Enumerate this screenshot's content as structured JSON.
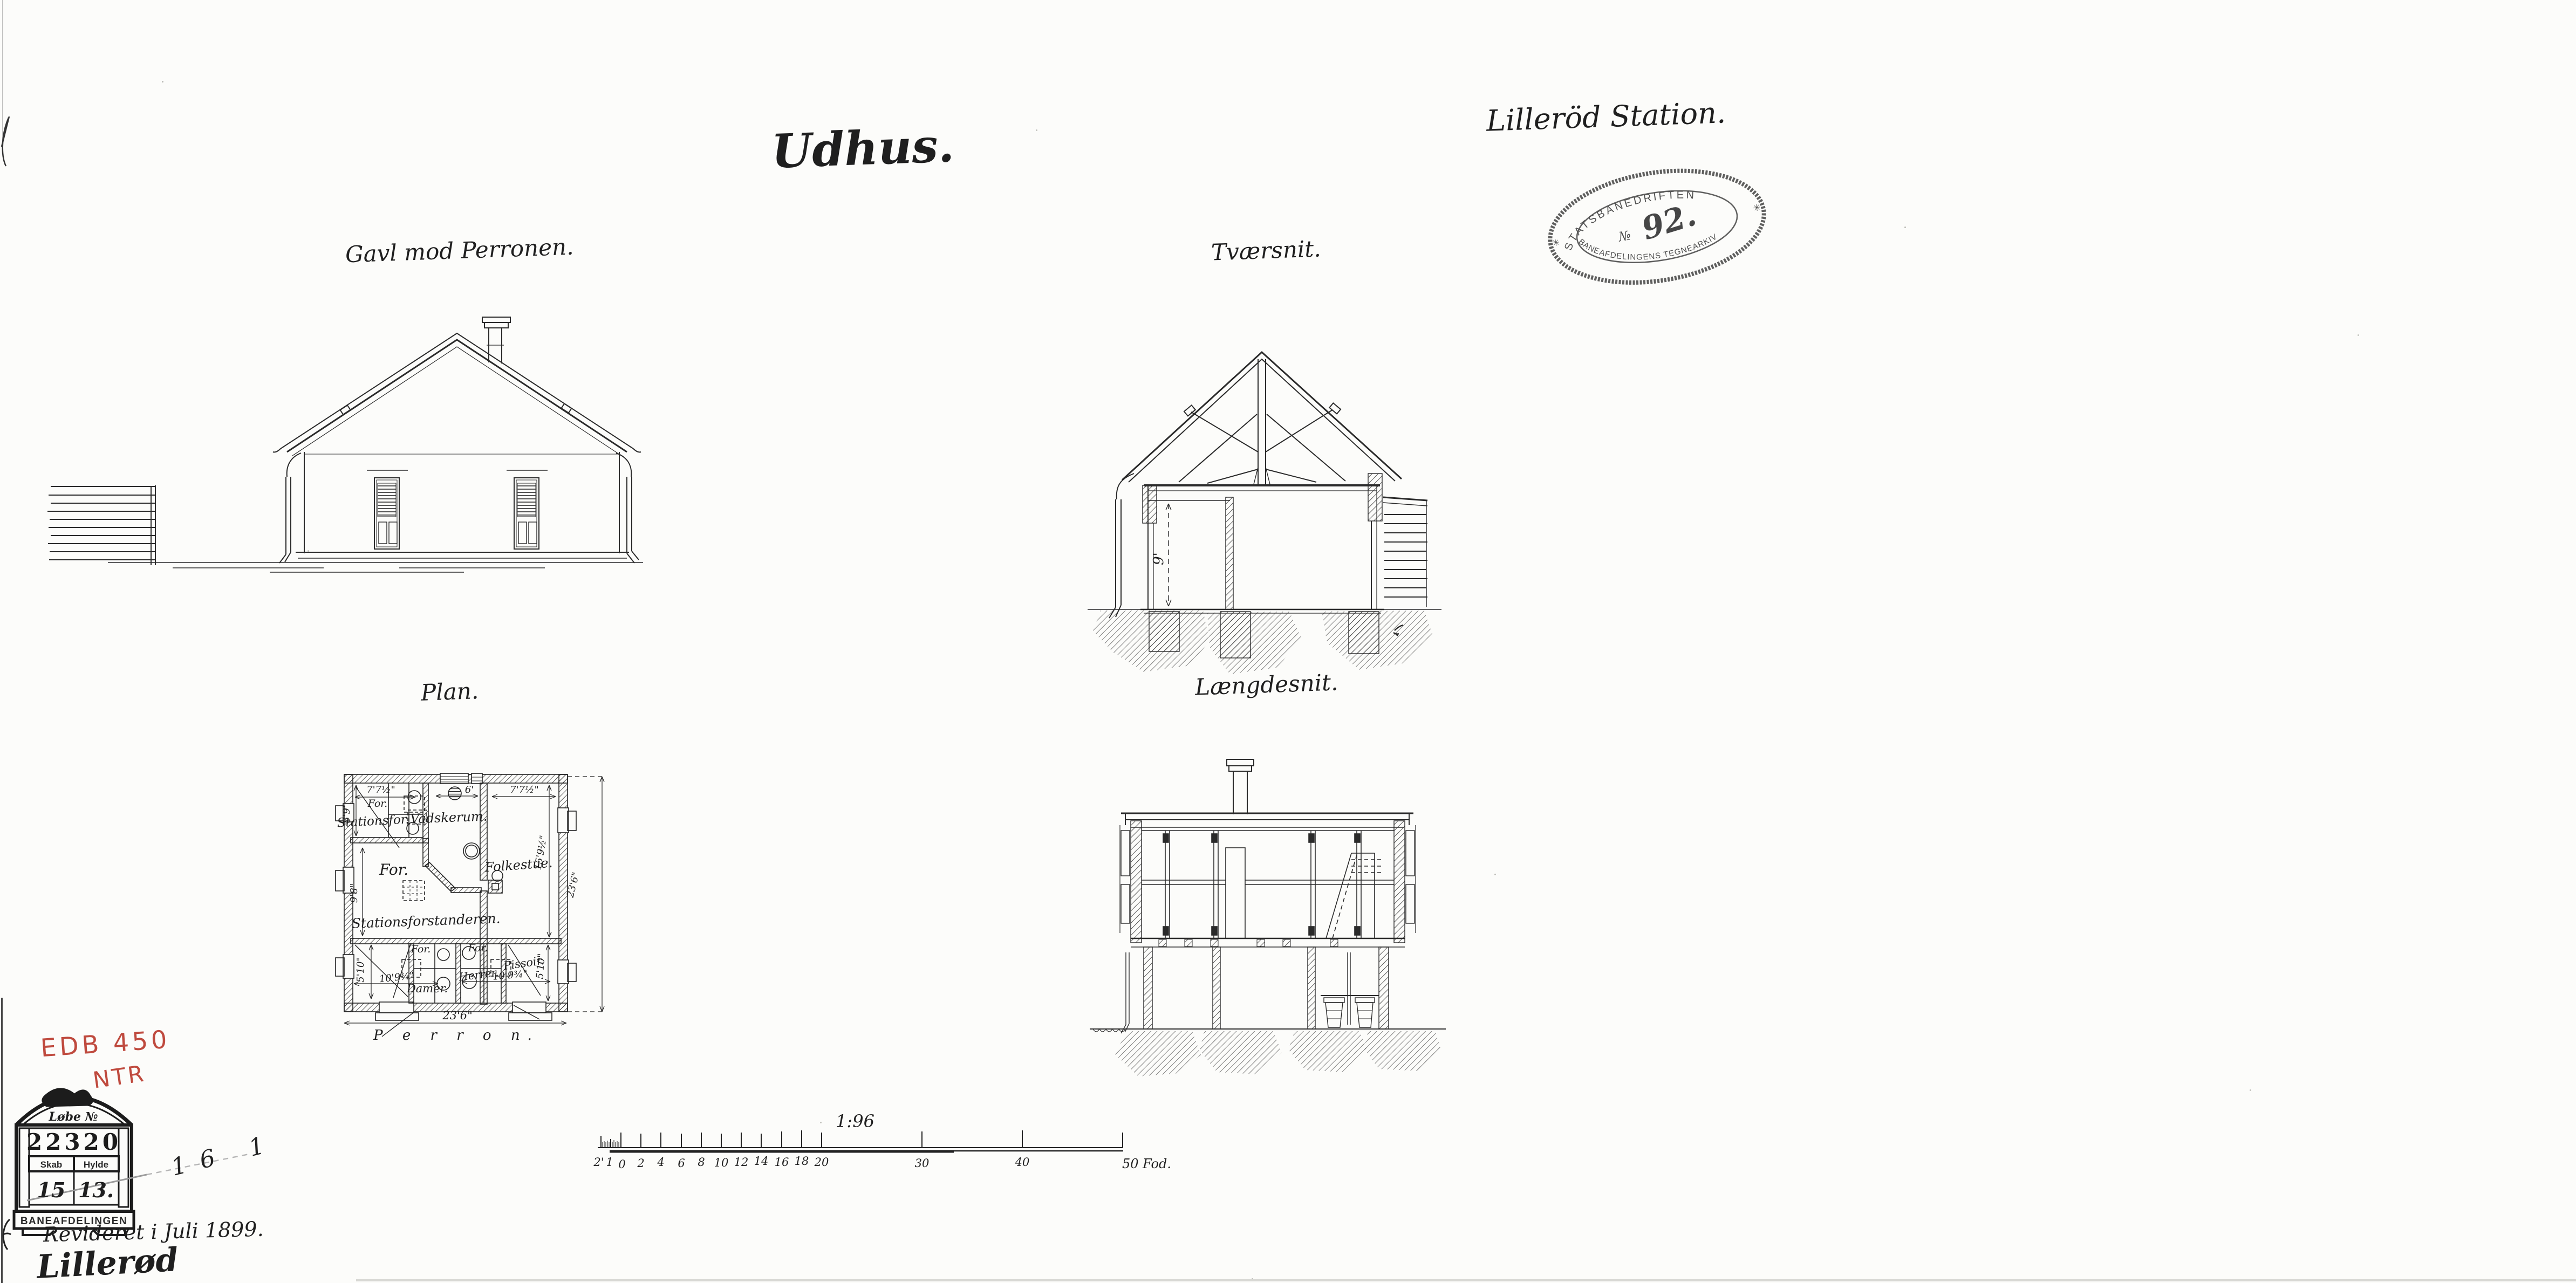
{
  "header": {
    "title": "Udhus.",
    "station": "Lilleröd Station."
  },
  "oval_stamp": {
    "top": "STATSBANEDRIFTEN",
    "no_sign": "№",
    "number": "92.",
    "bottom": "BANEAFDELINGENS TEGNEARKIV",
    "star_left": "✳",
    "star_right": "✳"
  },
  "views": {
    "gable_label": "Gavl mod Perronen.",
    "cross_label": "Tværsnit.",
    "plan_label": "Plan.",
    "long_label": "Længdesnit."
  },
  "cross_section": {
    "height_dim": "9'"
  },
  "plan": {
    "stationsfor": "Stationsfor.",
    "dim_5_9": "5'9\"",
    "dim_7_7_left": "7'7½\"",
    "for_small_top": "For.",
    "vadskerum": "Vadskerum.",
    "dim_6": "6'",
    "dim_7_7_right": "7'7½\"",
    "folkestue": "Folkestue.",
    "dim_15_9": "15'9½\"",
    "for_hall": "For.",
    "dim_9_8": "9'8\"",
    "stationsforstanderen": "Stationsforstanderen.",
    "dim_5_10_left": "5'10\"",
    "dim_10_9_left": "10'9¾\"",
    "for_damer": "For.",
    "damer": "Damer.",
    "for_herrer": "For.",
    "herrer": "Herrer.",
    "pissoir": "Pissoir.",
    "dim_10_9_right": "10'9¾\"",
    "dim_5_10_right": "5'10\"",
    "dim_23_6_bottom": "23'6\"",
    "dim_23_6_right": "23'6\"",
    "perron": "P e r r o n."
  },
  "scalebar": {
    "ratio": "1:96",
    "ticks": [
      "2'",
      "1",
      "0",
      "2",
      "4",
      "6",
      "8",
      "10",
      "12",
      "14",
      "16",
      "18",
      "20",
      "30",
      "40"
    ],
    "end_label": "50 Fod."
  },
  "annotations": {
    "edb": "EDB 450",
    "ntr": "NTR",
    "pencil_nums": "16 14",
    "revised": "Revideret i Juli 1899.",
    "signature": "Lillerød"
  },
  "archive_stamp": {
    "header": "Løbe №",
    "number": "22320",
    "skab": "Skab",
    "hylde": "Hylde",
    "skab_val": "15",
    "hylde_val": "13.",
    "footer": "BANEAFDELINGEN"
  }
}
